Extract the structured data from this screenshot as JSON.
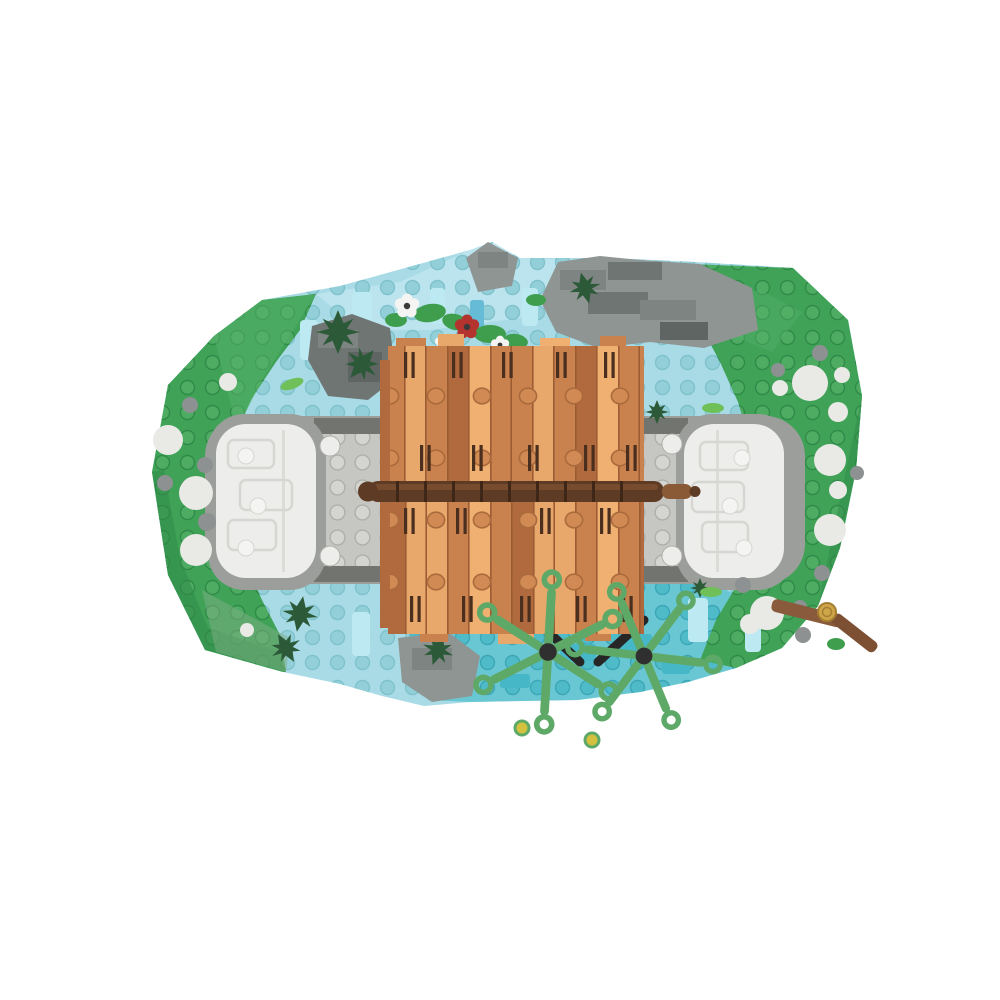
{
  "scene": {
    "kind": "product-photo",
    "subject": "lego-moc-covered-bridge-diorama-top-view",
    "parts": [
      "irregular-landscape-baseplate",
      "river-with-transparent-tiles",
      "grass-banks-with-round-stones",
      "stone-road-with-white-abutments",
      "wooden-covered-bridge-roof",
      "ridge-beam",
      "pine-sprigs",
      "flower-clusters",
      "aquatic-spider-plants",
      "log-with-gold-coin",
      "rock-outcrops"
    ]
  },
  "palette": {
    "background": "#ffffff",
    "water": "#a9dbe6",
    "water_pale": "#c6eaf2",
    "water_teal": "#62c4d2",
    "water_stud": "#93cfd8",
    "water_stud_edge": "#7fc2cc",
    "teal_stud": "#4fbac8",
    "teal_stud_edge": "#3aa6b6",
    "teal_brick": "#45b7c6",
    "trans_tile": "#bde9f2",
    "azure_tile": "#66bcd6",
    "grass": "#3fa257",
    "grass_light": "#58b16b",
    "grass_dark": "#2f8a47",
    "grass_sage": "#7fae86",
    "grass_stud": "#4dac62",
    "grass_stud_edge": "#2f8a47",
    "road": "#c6c6c2",
    "road_stud": "#d4d4d0",
    "road_stud_edge": "#aeaeaa",
    "road_dark": "#71746f",
    "road_bed": "#9b9e9a",
    "white_piece": "#ededeb",
    "white_seam": "#d6d6d2",
    "rock": "#8f9593",
    "rock_mid": "#7e8482",
    "rock_dark": "#6f7573",
    "rock_deep": "#5f6563",
    "roof_mid": "#c9814e",
    "roof_dark": "#b06a3e",
    "roof_light": "#e9a86b",
    "roof_pale": "#f0b071",
    "roof_seam": "#9c5c33",
    "roof_stud": "#d18a54",
    "roof_stud_edge": "#aa6a3c",
    "ridge": "#5e3b25",
    "ridge_hi": "#8a5a36",
    "ridge_seam": "#3f2718",
    "grille": "#4a2e1e",
    "pine": "#2c5a38",
    "leaf": "#3e9e4e",
    "lime": "#6fc058",
    "plant": "#5fa968",
    "plant_center": "#2f2f2f",
    "plant_tip_yellow": "#d4c23e",
    "flower_white": "#f4f4f2",
    "flower_red": "#b5332e",
    "flower_center": "#3a3a3a",
    "stone_white": "#e9e9e5",
    "stone_gray": "#8d9192",
    "stick": "#8a5a3c",
    "stick_dark": "#7d5034",
    "coin": "#cfa54a",
    "coin_edge": "#a57f2f",
    "black": "#262626"
  }
}
